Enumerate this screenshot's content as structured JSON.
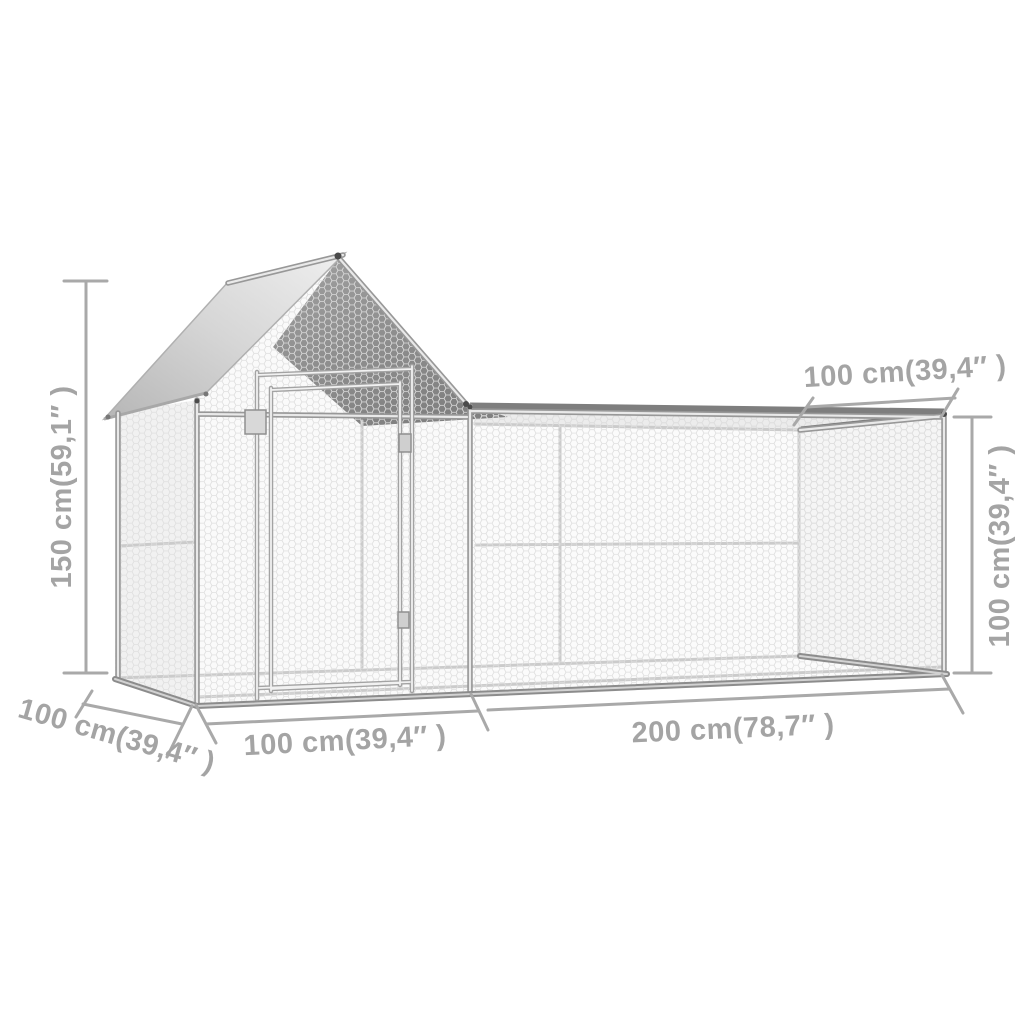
{
  "diagram": {
    "type": "product-dimension-diagram",
    "product": "chicken coop with gabled roof and wire mesh run",
    "background": "#ffffff",
    "annotation_color": "#a4a4a4",
    "dimensions": {
      "total_height": "150 cm(59,1″ )",
      "run_depth_top": "100 cm(39,4″ )",
      "run_height": "100 cm(39,4″ )",
      "coop_depth": "100 cm(39,4″ )",
      "coop_width": "100 cm(39,4″ )",
      "run_length": "200 cm(78,7″ )"
    },
    "colors": {
      "roof_panel_light": "#d6d6d6",
      "roof_panel_dark": "#8f8f8f",
      "frame_tube": "#c6c6c6",
      "wire_mesh": "#dedede",
      "base_rail": "#8c8c8c"
    }
  }
}
